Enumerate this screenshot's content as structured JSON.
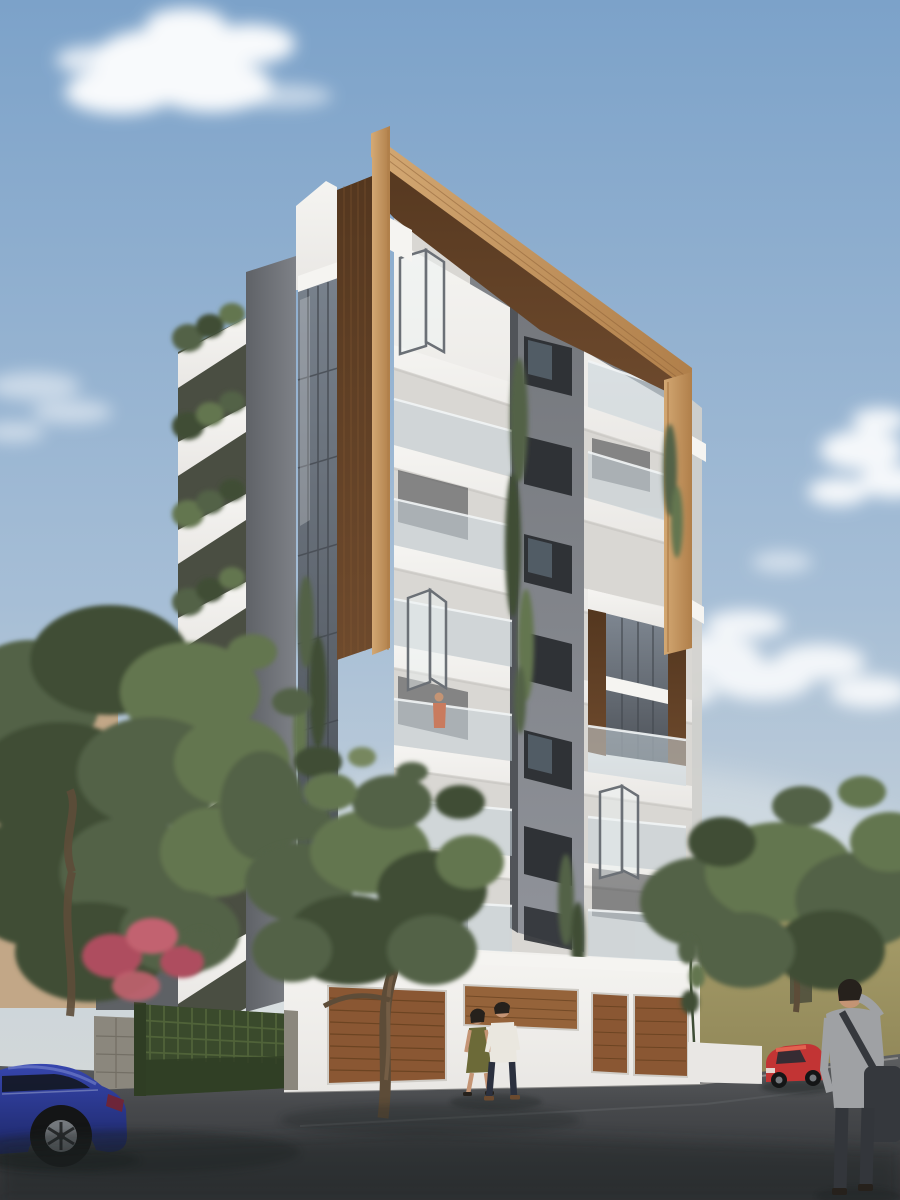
{
  "scene": {
    "type": "architectural-exterior-render",
    "description": "3D architectural rendering of a modern multi-storey apartment building with white cantilevered balconies, dark grey accents and a large wooden frame crowning the corner; olive trees, a green garden gate, a blue parked car, a red car, a strolling couple and a man with a shoulder bag on the street below under a blue sky with soft clouds.",
    "objects": [
      "sky with clouds",
      "modern apartment building",
      "wooden corner frame",
      "stacked white balconies with planting",
      "glass curtain wall strip",
      "grey window band",
      "wood-clad balcony box",
      "hanging vines",
      "ground floor with wooden garage doors",
      "green lattice gate",
      "stone wall",
      "olive trees",
      "bougainvillea",
      "beige neighbour building",
      "grey neighbour building",
      "olive-green neighbour house with roof railing",
      "asphalt street",
      "blue car",
      "red car",
      "walking couple",
      "man with shoulder bag",
      "person on balcony"
    ]
  },
  "palette": {
    "sky_top": "#7ca2c9",
    "sky_mid": "#a6bed6",
    "sky_low": "#cbd4da",
    "sky_horizon": "#dadcd8",
    "cloud": "#ffffff",
    "white_hi": "#f5f4f1",
    "white_mid": "#e9e7e4",
    "white_low": "#d9d7d3",
    "white_shadow": "#c9c7c3",
    "slab_gap": "#4a4e42",
    "column_dark": "#5f6267",
    "column_light": "#7e8187",
    "glass_strip": "#78818c",
    "glass_line": "#454a51",
    "glass_light": "#cfd9df",
    "glass_rail": "#c9d5dc",
    "band_top": "#74777c",
    "band_bot": "#90939a",
    "win_dark": "#2f3236",
    "win_glass": "#5a6672",
    "wood_light": "#d3a873",
    "wood_light2": "#b07f4a",
    "wood_mid": "#a97c48",
    "wood_dark": "#6e4a2d",
    "wood_dark2": "#54371f",
    "wood_grain": "#8a5e35",
    "garage_wood": "#8a5733",
    "garage_wood_dark": "#65401f",
    "garage_sign": "#95633a",
    "street_far": "#5e6062",
    "street_mid": "#47494c",
    "street_near": "#323437",
    "seam": "#595b5e",
    "sidewalk": "#6a6c6e",
    "gate_green": "#3a4a2c",
    "gate_lattice": "#55683c",
    "gate_dark": "#2f3d24",
    "stone": "#8b877d",
    "stone_line": "#6e6a60",
    "beige": "#c2a787",
    "beige_top": "#d9ccb8",
    "bg_gray": "#5e6165",
    "bg_win": "#8694a2",
    "house_olive": "#aaa06b",
    "house_olive2": "#8f8658",
    "house_parapet": "#d6d3c3",
    "house_rail": "#45473a",
    "house_win": "#3a3d33",
    "house_box": "#dcd8c6",
    "foliage_dark": "#3f4e36",
    "foliage_mid": "#536247",
    "foliage_light": "#64764f",
    "foliage_pale": "#77875f",
    "trunk": "#5d4c38",
    "trunk_light": "#7a6248",
    "flower_pink": "#ae4d5f",
    "flower_pink2": "#c2626f",
    "car_blue": "#3646ae",
    "car_blue_dark": "#1d2766",
    "car_blue_hi": "#8f9cdc",
    "car_red": "#c23434",
    "car_red_hi": "#e26250",
    "tire": "#141516",
    "rim": "#75797e",
    "skin": "#c49474",
    "hair_dark": "#26211c",
    "shirt_light": "#eae7df",
    "pants_navy": "#2b303e",
    "dress_olive": "#6c6a38",
    "shoe_brown": "#6b4a2f",
    "man_top": "#9fa1a4",
    "man_pants": "#33363b",
    "bag": "#35383d",
    "shadow": "#1f2124"
  }
}
